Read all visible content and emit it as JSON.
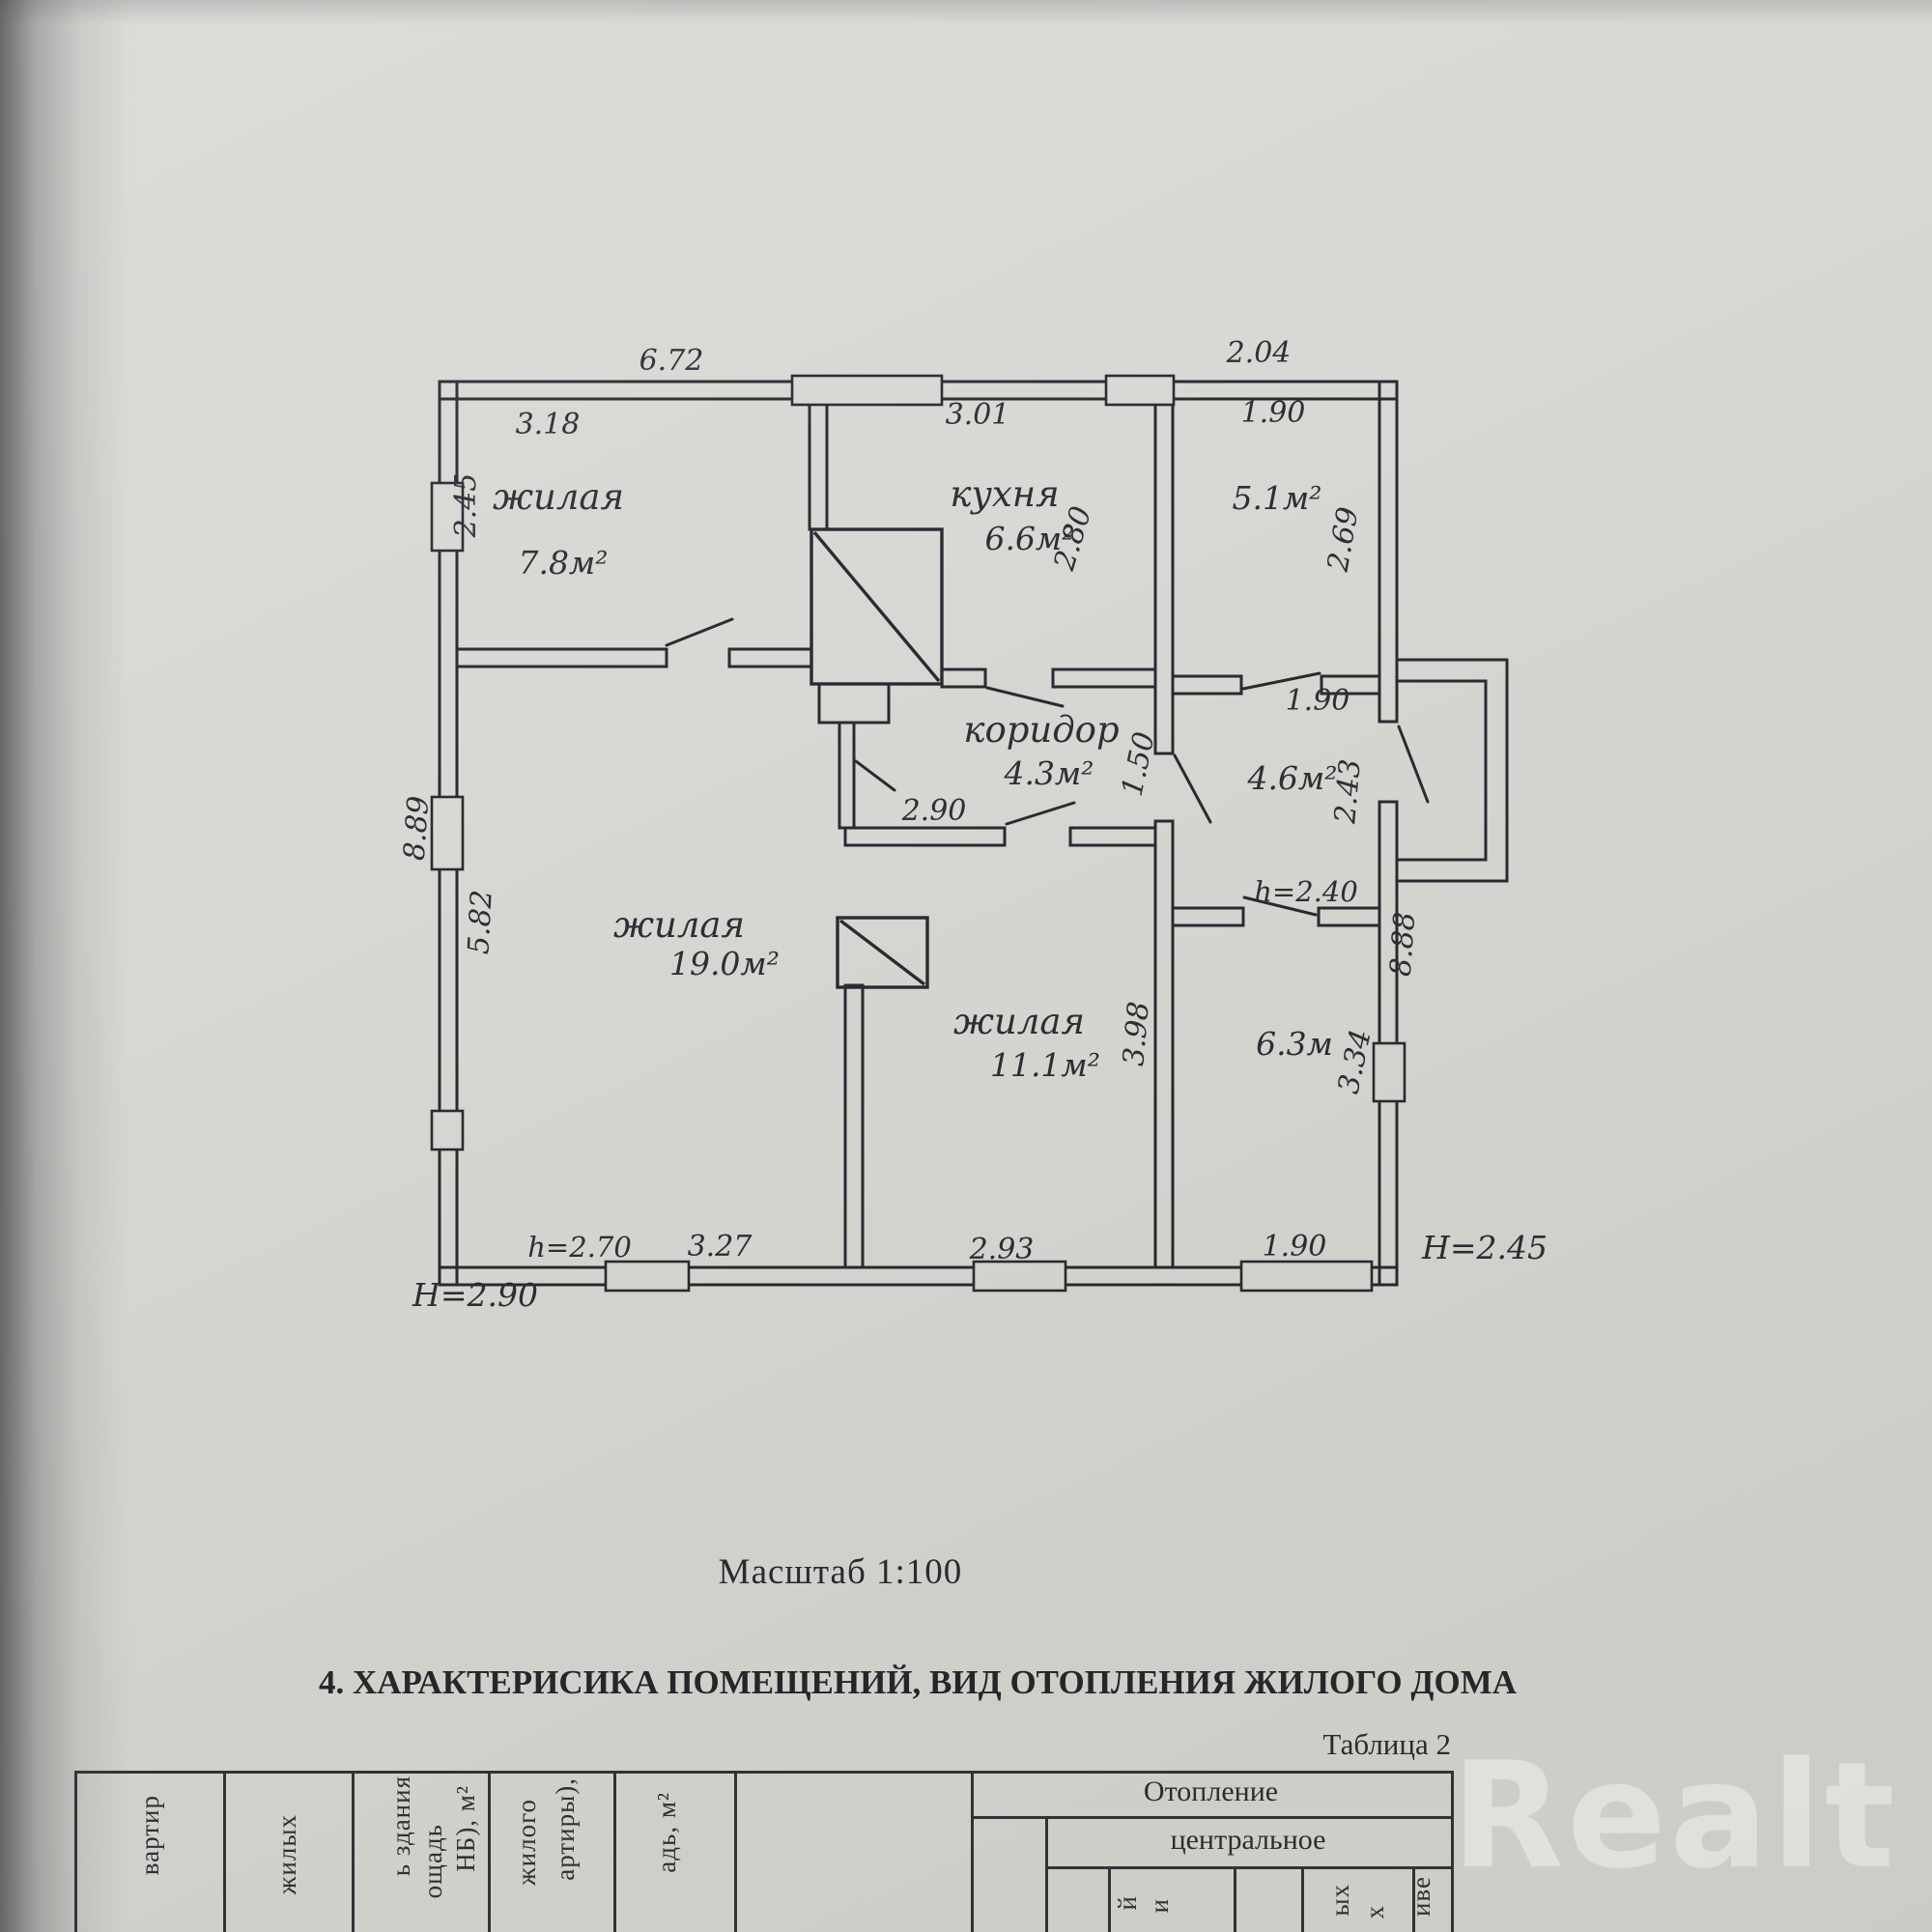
{
  "plan": {
    "dims": {
      "top_main": "6.72",
      "top_annex": "2.04",
      "r78_w": "3.18",
      "r78_h": "2.45",
      "kitchen_w": "3.01",
      "kitchen_h": "2.80",
      "r51_w": "1.90",
      "r51_h": "2.69",
      "r51_door": "1.90",
      "left_total": "8.89",
      "r190_h": "5.82",
      "corridor_h": "1.50",
      "corridor_w": "2.90",
      "r46_h": "2.43",
      "r111_h": "3.98",
      "r63_h": "3.34",
      "h_annex_mid": "h=2.40",
      "h_main": "h=2.70",
      "r190_w": "3.27",
      "r111_w": "2.93",
      "r63_w": "1.90",
      "right_total": "8.88",
      "H_annex": "Н=2.45",
      "H_main": "Н=2.90"
    },
    "rooms": {
      "r78": {
        "name": "жилая",
        "area": "7.8м²"
      },
      "kitchen": {
        "name": "кухня",
        "area": "6.6м²"
      },
      "r51": {
        "area": "5.1м²"
      },
      "corridor": {
        "name": "коридор",
        "area": "4.3м²"
      },
      "r46": {
        "area": "4.6м²"
      },
      "r190": {
        "name": "жилая",
        "area": "19.0м²"
      },
      "r111": {
        "name": "жилая",
        "area": "11.1м²"
      },
      "r63": {
        "area": "6.3м"
      }
    }
  },
  "caption": "Масштаб 1:100",
  "section_title": "4. ХАРАКТЕРИСИКА ПОМЕЩЕНИЙ, ВИД ОТОПЛЕНИЯ ЖИЛОГО ДОМА",
  "table_label": "Таблица 2",
  "table": {
    "heating": "Отопление",
    "central": "центральное",
    "col_flats": "вартир",
    "col_living": "жилых",
    "col_bld1": "ь здания",
    "col_bld2": "ощадь",
    "col_bld3": "НБ), м²",
    "col_house1": "жилого",
    "col_house2": "артиры),",
    "col_area": "адь, м²",
    "frag_i1": "й",
    "frag_i2": "и",
    "frag_yh": "ых",
    "frag_h": "х",
    "frag_ive": "иве"
  },
  "watermark": "Realt"
}
